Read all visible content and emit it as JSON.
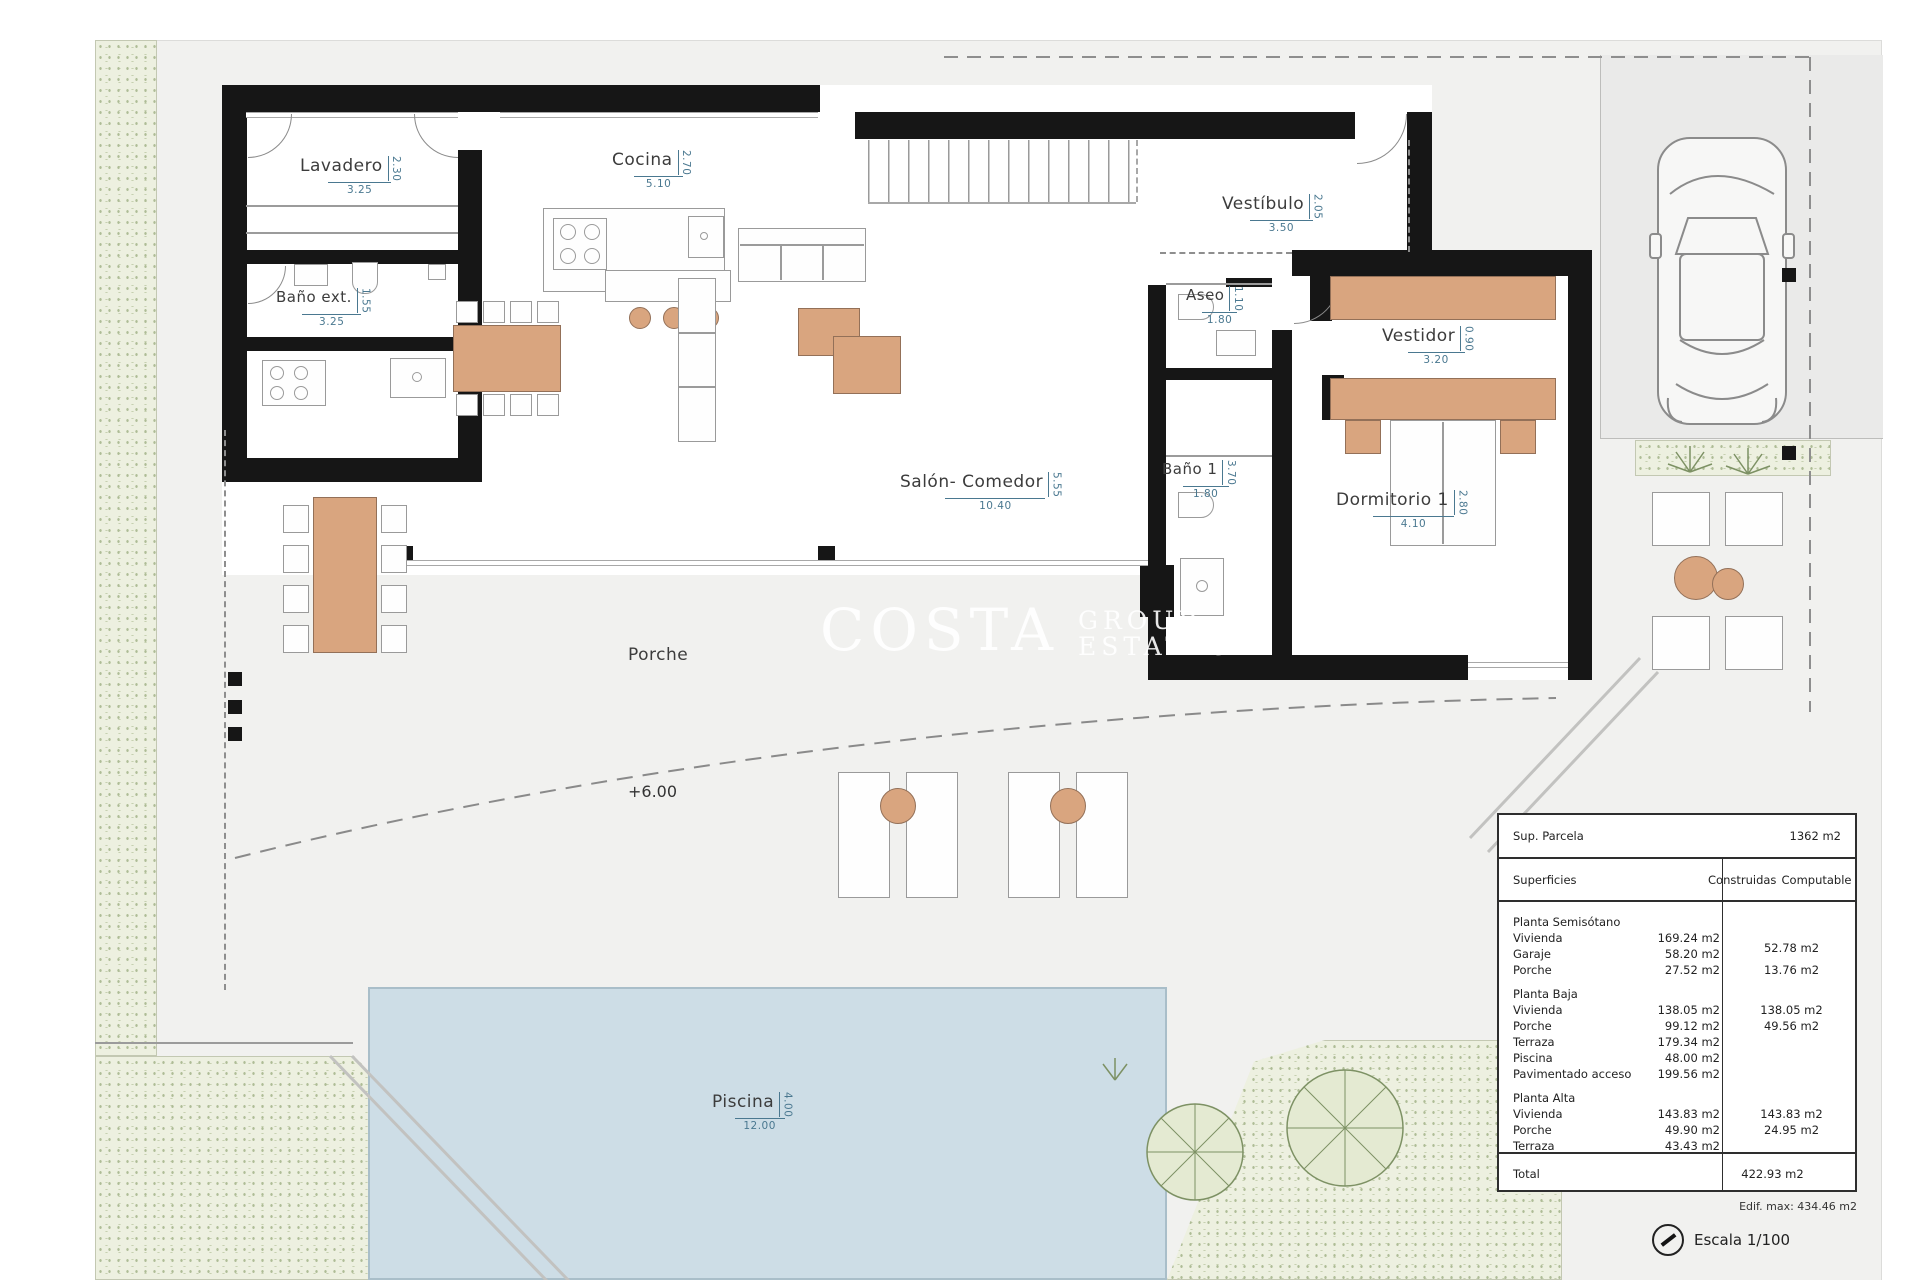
{
  "plan": {
    "watermark": {
      "word1": "COSTA",
      "word2": "GROUP",
      "word3": "ESTATES"
    },
    "level_marker": "+6.00",
    "porche_label": "Porche",
    "rooms": {
      "lavadero": {
        "name": "Lavadero",
        "w": "3.25",
        "h": "2.30"
      },
      "bano_ext": {
        "name": "Baño ext.",
        "w": "3.25",
        "h": "1.55"
      },
      "cocina": {
        "name": "Cocina",
        "w": "5.10",
        "h": "2.70"
      },
      "vestibulo": {
        "name": "Vestíbulo",
        "w": "3.50",
        "h": "2.05"
      },
      "aseo": {
        "name": "Aseo",
        "w": "1.80",
        "h": "1.10"
      },
      "bano1": {
        "name": "Baño 1",
        "w": "1.80",
        "h": "3.70"
      },
      "vestidor": {
        "name": "Vestidor",
        "w": "3.20",
        "h": "0.90"
      },
      "dormitorio1": {
        "name": "Dormitorio 1",
        "w": "4.10",
        "h": "2.80"
      },
      "salon": {
        "name": "Salón-  Comedor",
        "w": "10.40",
        "h": "5.55"
      },
      "piscina": {
        "name": "Piscina",
        "w": "12.00",
        "h": "4.00"
      }
    }
  },
  "areas_table": {
    "sup_parcela_label": "Sup. Parcela",
    "sup_parcela_value": "1362 m2",
    "col_superficies": "Superficies",
    "col_construidas": "Construidas",
    "col_computable": "Computable",
    "rows": [
      {
        "label": "Planta Semisótano",
        "c1": "",
        "c2": ""
      },
      {
        "label": "Vivienda",
        "c1": "169.24 m2",
        "c2": "52.78 m2"
      },
      {
        "label": "Garaje",
        "c1": "58.20 m2",
        "c2": ""
      },
      {
        "label": "Porche",
        "c1": "27.52 m2",
        "c2": "13.76 m2"
      },
      {
        "label": "Planta Baja",
        "c1": "",
        "c2": ""
      },
      {
        "label": "Vivienda",
        "c1": "138.05 m2",
        "c2": "138.05 m2"
      },
      {
        "label": "Porche",
        "c1": "99.12 m2",
        "c2": "49.56 m2"
      },
      {
        "label": "Terraza",
        "c1": "179.34 m2",
        "c2": ""
      },
      {
        "label": "Piscina",
        "c1": "48.00 m2",
        "c2": ""
      },
      {
        "label": "Pavimentado acceso",
        "c1": "199.56 m2",
        "c2": ""
      },
      {
        "label": "Planta Alta",
        "c1": "",
        "c2": ""
      },
      {
        "label": "Vivienda",
        "c1": "143.83 m2",
        "c2": "143.83 m2"
      },
      {
        "label": "Porche",
        "c1": "49.90 m2",
        "c2": "24.95 m2"
      },
      {
        "label": "Terraza",
        "c1": "43.43 m2",
        "c2": ""
      }
    ],
    "total_label": "Total",
    "total_value": "422.93 m2"
  },
  "footer": {
    "note": "Edif. max: 434.46 m2",
    "escala": "Escala 1/100"
  }
}
